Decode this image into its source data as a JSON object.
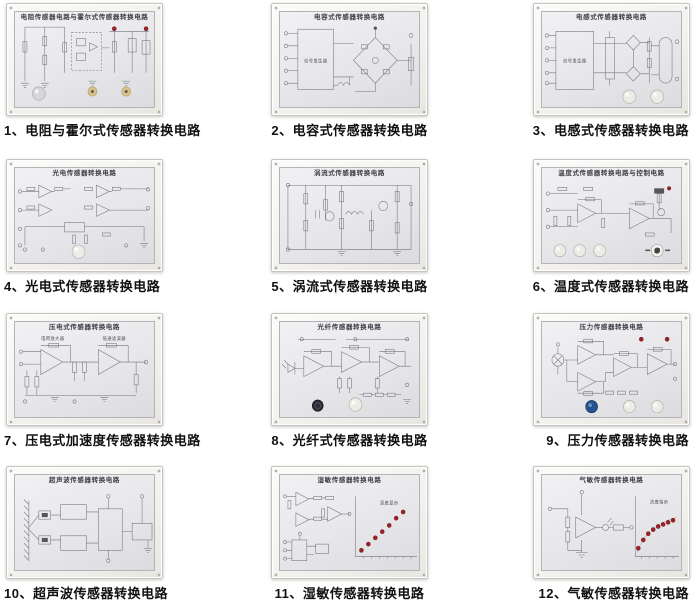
{
  "page": {
    "background": "#ffffff"
  },
  "colors": {
    "led_red": "#9e1f26",
    "graph_dot_red": "#9e1f26",
    "knob_white": "#edebe6",
    "knob_gray": "#d6d6d9",
    "knob_dark": "#2c2c37",
    "knob_blue": "#24548e",
    "terminal_brass": "#d9c287",
    "panel_face": "#e7e7ea",
    "frame": "#f3f1ed"
  },
  "panels": [
    {
      "caption": "1、电阻与霍尔式传感器转换电路",
      "title": "电阻传感器电路与霍尔式传感器转换电路"
    },
    {
      "caption": "2、电容式传感器转换电路",
      "title": "电容式传感器转换电路",
      "box_label": "信号发生器"
    },
    {
      "caption": "3、电感式传感器转换电路",
      "title": "电感式传感器转换电路",
      "box_label": "信号发生器"
    },
    {
      "caption": "4、光电式传感器转换电路",
      "title": "光电传感器转换电路"
    },
    {
      "caption": "5、涡流式传感器转换电路",
      "title": "涡流式传感器转换电路"
    },
    {
      "caption": "6、温度式传感器转换电路",
      "title": "温度式传感器转换电路与控制电路"
    },
    {
      "caption": "7、压电式加速度传感器转换电路",
      "title": "压电式传感器转换电路",
      "label_left": "电荷放大器",
      "label_right": "低通滤波器"
    },
    {
      "caption": "8、光纤式传感器转换电路",
      "title": "光纤传感器转换电路"
    },
    {
      "caption": "9、压力传感器转换电路",
      "title": "压力传感器转换电路"
    },
    {
      "caption": "10、超声波传感器转换电路",
      "title": "超声波传感器转换电路"
    },
    {
      "caption": "11、湿敏传感器转换电路",
      "title": "湿敏传感器转换电路",
      "graph_label": "湿度显示"
    },
    {
      "caption": "12、气敏传感器转换电路",
      "title": "气敏传感器转换电路",
      "graph_label": "浓度指示"
    }
  ]
}
